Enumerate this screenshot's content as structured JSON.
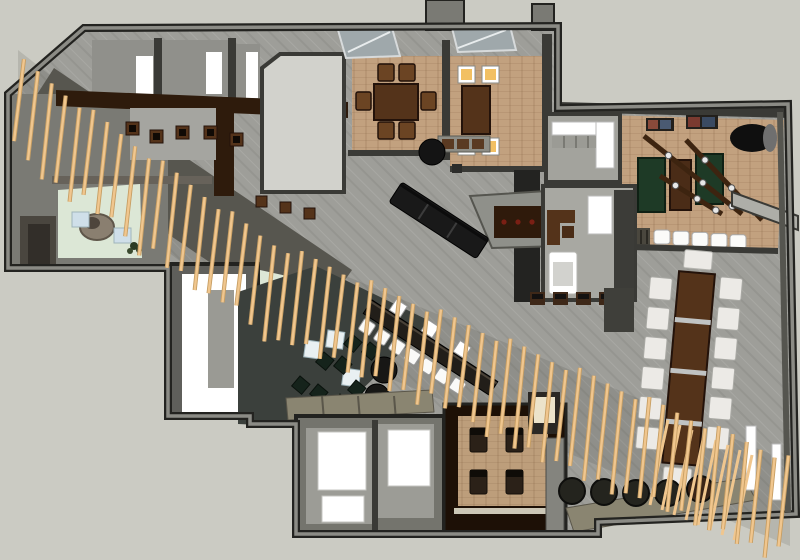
{
  "meta": {
    "view": "top-down-3d-floorplan-render",
    "subject": "restaurant-bar interior model",
    "canvas_w": 800,
    "canvas_h": 560
  },
  "palette": {
    "bg": "#cbcbc3",
    "tile": "#9e9e99",
    "wallMid": "#7a7a74",
    "wallLight": "#9c9c96",
    "wallDark": "#3a3a36",
    "outline": "#232320",
    "ramp": "#57564f",
    "walnutFloor": "#2e1b0c",
    "boothFloor": "#1d1006",
    "brick": "#c2a17f",
    "brick2": "#bd9e7b",
    "brickLine": "rgba(120,85,55,0.28)",
    "kitchen": "#d2d2cc",
    "mint": "#dce7d6",
    "charcoal": "#3b403c",
    "white": "#ffffff",
    "offWhite": "#eceae6",
    "chairWood": "#6b4423",
    "tableWood": "#54331a",
    "tableWoodDark": "#23120a",
    "amber": "#f2c063",
    "gameGreen": "#1e3a26",
    "railWood": "#3d2410",
    "slat": "#f0c68e",
    "slatEdge": "#c79e63",
    "olive": "#8a8571",
    "black": "#141414",
    "greenChair": "#15231b",
    "blueBench": "#cfdfe9",
    "cubeTable": "#e9f0f2",
    "artOrange": "#b06038",
    "artTeal": "#3f6673",
    "rock": "#8a7f70",
    "rock2": "#97907e",
    "steel": "#c0c3c3",
    "cream": "#ece3ca",
    "skylight": "#9fa8ab",
    "maroon": "#7a1f14",
    "ottoman": "#24241e"
  },
  "counts": {
    "ceiling_slats": 56,
    "bar_stools": 7,
    "bar_white_tops": 3,
    "banquette_segments": 3,
    "communal_chairs_per_side": 6,
    "communal_end_chairs": 2,
    "communal_metal_bands": 3,
    "lounge_chairs": 10,
    "lounge_cube_tables": 3,
    "lounge_ottomans": 2,
    "south_ottomans": 5,
    "games_counter_stools": 5,
    "game_tables": 3,
    "game_rails": 3,
    "wall_frames": 2,
    "dining_room_1_chairs": 6,
    "dining_room_2_chairs": 4,
    "booth_seats": 4,
    "restroom_door_panels": 3,
    "mint_wall_benches": 3,
    "entry_cube_benches": 2,
    "office_stools": 4,
    "hall_side_tables_row_a": 5,
    "hall_side_tables_row_b": 3,
    "service_dots": 4,
    "lean_wall_slats": 8
  },
  "regions": {
    "entry": "entry-vestibule",
    "dining1": "private-dining-room-1",
    "dining2": "private-dining-room-2",
    "games": "games-room",
    "office": "office-room",
    "pantry": "pantry-room",
    "hall": "main-hall",
    "lounge": "lounge-area",
    "restrooms": "restroom-block",
    "booth": "booth-room",
    "communal": "communal-table-area"
  }
}
